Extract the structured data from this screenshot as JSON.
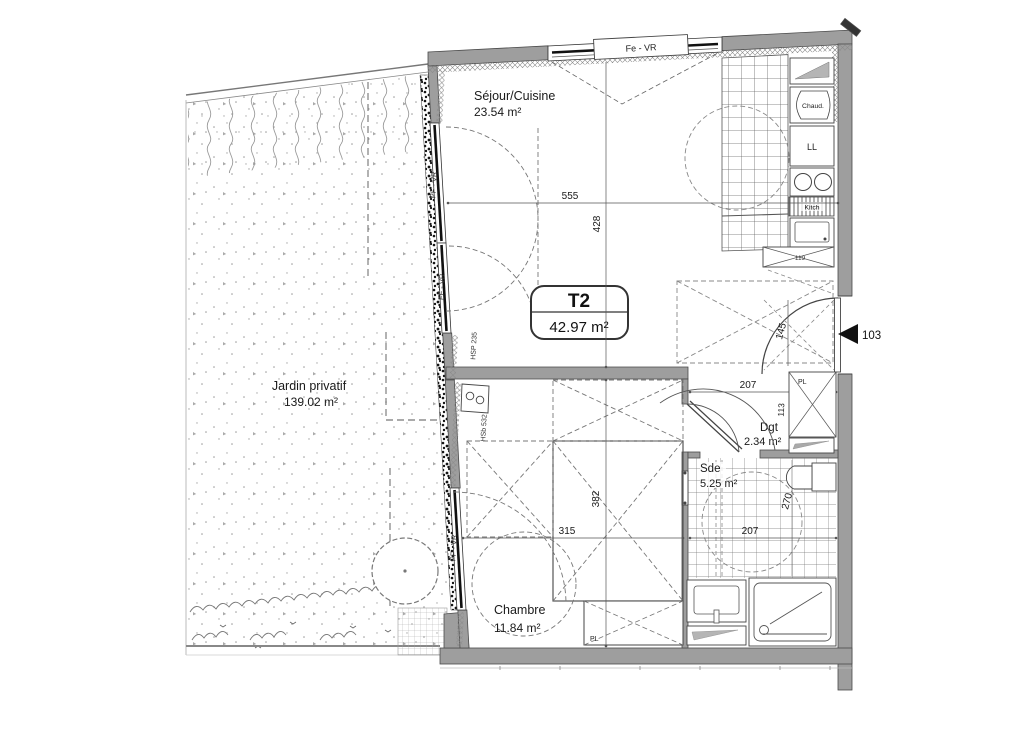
{
  "plan": {
    "unit": {
      "type": "T2",
      "area": "42.97 m²",
      "number": "103"
    },
    "rooms": {
      "sejour": {
        "name": "Séjour/Cuisine",
        "area": "23.54 m²"
      },
      "jardin": {
        "name": "Jardin privatif",
        "area": "139.02 m²"
      },
      "chambre": {
        "name": "Chambre",
        "area": "11.84 m²"
      },
      "dgt": {
        "name": "Dgt",
        "area": "2.34 m²"
      },
      "sde": {
        "name": "Sde",
        "area": "5.25 m²"
      }
    },
    "windows": {
      "top": "Fe - VR",
      "sejour_upper": "PF - VR",
      "sejour_lower": "FF - VR",
      "chambre": "PF - VR"
    },
    "notes": {
      "sejour_height": "HSP 235",
      "chambre_sill": "HSb 532"
    },
    "fixtures": {
      "boiler": "Chaud.",
      "washing_machine": "LL",
      "kitchen": "Kitch",
      "entry_closet": "PL",
      "bedroom_closet": "PL"
    },
    "dims": {
      "sejour_width": "555",
      "sejour_depth": "428",
      "entry_width": "207",
      "entry_closet_depth": "113",
      "entry_door": "145",
      "fridge": "119",
      "chambre_depth": "382",
      "chambre_width": "315",
      "sde_width": "207",
      "sde_depth": "270"
    },
    "colors": {
      "wall": "#9e9e9e",
      "line": "#444444",
      "text": "#1a1a1a",
      "marker": "#111111"
    }
  }
}
